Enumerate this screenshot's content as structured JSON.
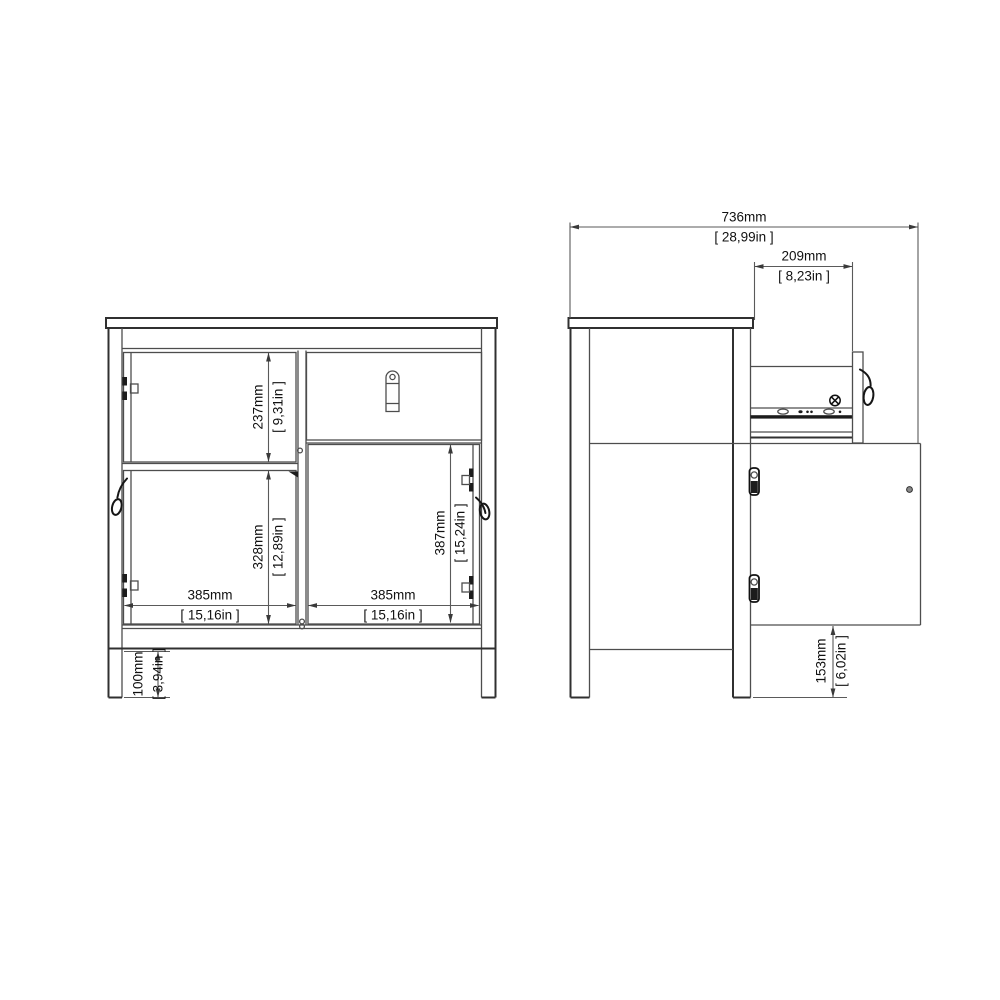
{
  "page": {
    "background": "#ffffff",
    "line_color": "#4d4d4d",
    "text_color": "#111111",
    "description": "Technical dimension drawing of a sideboard with 2 doors and 1 drawer, front elevation and side elevation with drawer and door open"
  },
  "views": {
    "front": {
      "label": "front-view",
      "dims": {
        "upper_door_h": {
          "mm": "237mm",
          "in": "[ 9,31in ]"
        },
        "left_door_h": {
          "mm": "328mm",
          "in": "[ 12,89in ]"
        },
        "right_door_h": {
          "mm": "387mm",
          "in": "[ 15,24in ]"
        },
        "left_w": {
          "mm": "385mm",
          "in": "[ 15,16in ]"
        },
        "right_w": {
          "mm": "385mm",
          "in": "[ 15,16in ]"
        },
        "leg_h": {
          "mm": "100mm",
          "in": "[ 3,94in ]"
        }
      }
    },
    "side": {
      "label": "side-view",
      "dims": {
        "depth_open": {
          "mm": "736mm",
          "in": "[ 28,99in ]"
        },
        "drawer_ext": {
          "mm": "209mm",
          "in": "[ 8,23in ]"
        },
        "clearance_h": {
          "mm": "153mm",
          "in": "[ 6,02in ]"
        }
      }
    }
  }
}
